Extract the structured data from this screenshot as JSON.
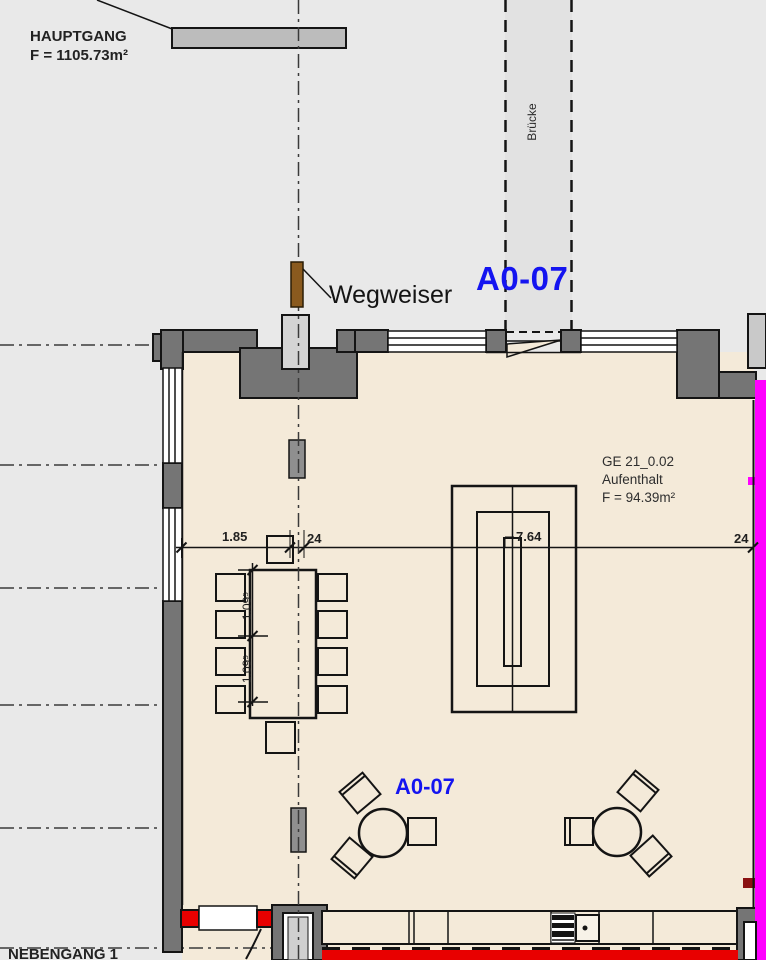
{
  "drawing": {
    "type": "architectural-floor-plan",
    "corridor_top": {
      "label": "HAUPTGANG",
      "area": "F = 1105.73m²"
    },
    "bridge": {
      "label": "Brücke"
    },
    "signpost": {
      "label": "Wegweiser"
    },
    "zone": {
      "code_top": "A0-07",
      "code_bottom": "A0-07"
    },
    "room": {
      "id": "GE 21_0.02",
      "name": "Aufenthalt",
      "area": "F = 94.39m²"
    },
    "corridor_bottom": {
      "label": "NEBENGANG 1"
    },
    "dimensions": {
      "horizontal": [
        "1.85",
        "24",
        "7.64",
        "24"
      ],
      "vertical": [
        "1.09⁵",
        "1.09⁵"
      ]
    },
    "colors": {
      "background": "#e9e9e9",
      "bridge_fill": "#e2e2e2",
      "floor_fill": "#f4ead9",
      "wall_fill": "#757575",
      "line": "#141414",
      "zone_text": "#1414f0",
      "fire_wall_magenta": "#ff00ff",
      "alert_red": "#e80000",
      "dark_red_marker": "#8a1111",
      "signpost_brown": "#8a5a1e",
      "sign_gray": "#bcbcbc"
    }
  }
}
